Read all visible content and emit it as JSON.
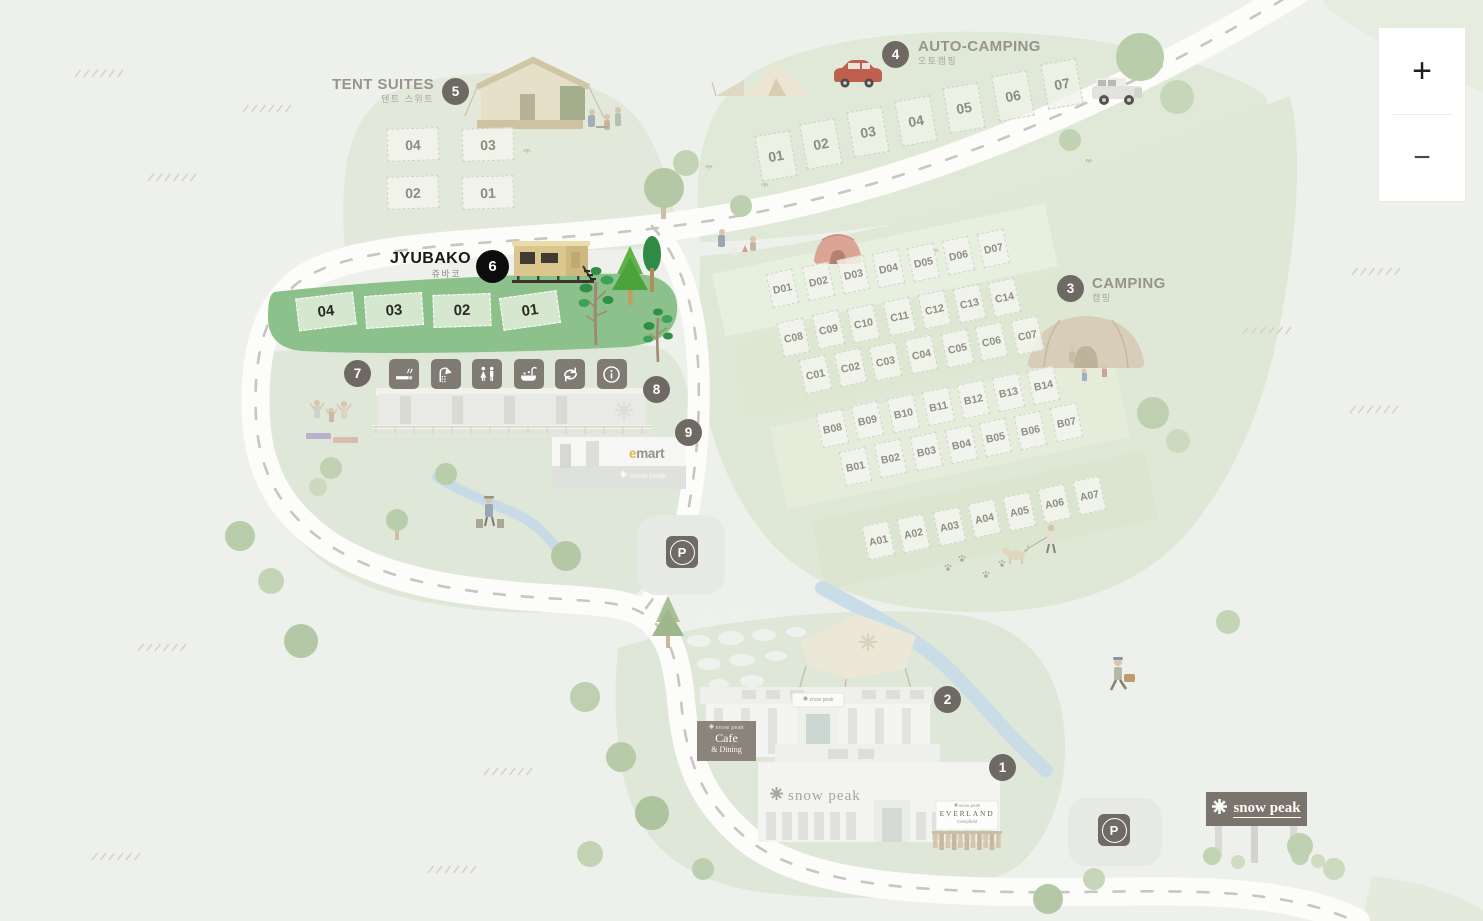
{
  "zoom_controls": {
    "zoom_in": "+",
    "zoom_out": "−"
  },
  "zones": {
    "tent_suites": {
      "label": "TENT SUITES",
      "sublabel": "텐트 스위트",
      "marker": "5"
    },
    "auto_camping": {
      "label": "AUTO-CAMPING",
      "sublabel": "오토캠핑",
      "marker": "4"
    },
    "jyubako": {
      "label": "JYUBAKO",
      "sublabel": "쥬바코",
      "marker": "6"
    },
    "camping": {
      "label": "CAMPING",
      "sublabel": "캠핑",
      "marker": "3"
    }
  },
  "markers": {
    "m1": "1",
    "m2": "2",
    "m7": "7",
    "m8": "8",
    "m9": "9"
  },
  "sites": {
    "tent_suites": [
      "04",
      "03",
      "02",
      "01"
    ],
    "auto_camping": [
      "01",
      "02",
      "03",
      "04",
      "05",
      "06",
      "07"
    ],
    "jyubako": [
      "04",
      "03",
      "02",
      "01"
    ],
    "camping_d": [
      "D01",
      "D02",
      "D03",
      "D04",
      "D05",
      "D06",
      "D07"
    ],
    "camping_c_upper": [
      "C08",
      "C09",
      "C10",
      "C11",
      "C12",
      "C13",
      "C14"
    ],
    "camping_c_lower": [
      "C01",
      "C02",
      "C03",
      "C04",
      "C05",
      "C06",
      "C07"
    ],
    "camping_b_upper": [
      "B08",
      "B09",
      "B10",
      "B11",
      "B12",
      "B13",
      "B14"
    ],
    "camping_b_lower": [
      "B01",
      "B02",
      "B03",
      "B04",
      "B05",
      "B06",
      "B07"
    ],
    "camping_a": [
      "A01",
      "A02",
      "A03",
      "A04",
      "A05",
      "A06",
      "A07"
    ]
  },
  "facilities": [
    {
      "name": "smoking-area-icon"
    },
    {
      "name": "shower-icon"
    },
    {
      "name": "restroom-icon"
    },
    {
      "name": "washroom-icon"
    },
    {
      "name": "recycling-icon"
    },
    {
      "name": "information-icon"
    }
  ],
  "signs": {
    "parking": "P",
    "billboard": {
      "name": "snow peak"
    },
    "store": {
      "name": "snow peak"
    },
    "cafe_arch": {
      "name": "snow peak"
    },
    "emart": {
      "e": "e",
      "mart": "mart",
      "sub": "snow peak"
    },
    "cafe_dining": {
      "brand": "snow peak",
      "title": "Cafe",
      "subtitle": "& Dining"
    },
    "everland": {
      "brand": "snow peak",
      "title": "EVERLAND",
      "subtitle": "Campfield"
    }
  },
  "colors": {
    "accent_green": "#8dc18b",
    "marker_gray": "#6e6963",
    "marker_active": "#0c0c0c",
    "road": "#fcfcfa"
  }
}
